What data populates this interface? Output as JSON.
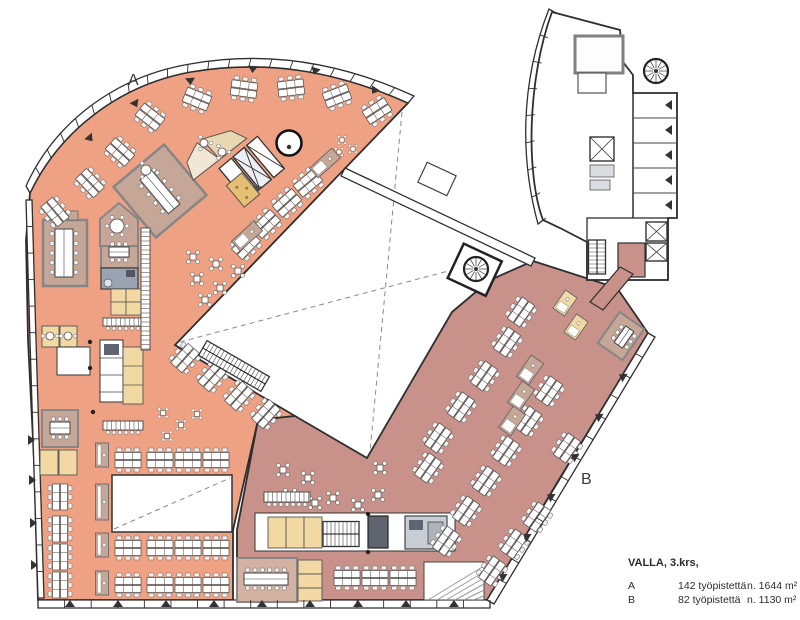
{
  "zone_labels": {
    "a": "A",
    "b": "B"
  },
  "legend": {
    "title": "VALLA, 3.krs,",
    "rows": [
      {
        "zone": "A",
        "workstations": "142 työpistettä",
        "area": "n. 1644 m²"
      },
      {
        "zone": "B",
        "workstations": "82 työpistettä",
        "area": "n. 1130 m²"
      }
    ]
  },
  "colors": {
    "zone_a": "#efa183",
    "zone_b": "#c8928a",
    "room_tan": "#c6a697",
    "room_tan_light": "#d3b2a2",
    "wedge_light": "#f0e8d4",
    "wedge_dark": "#e7d7b2",
    "yellow": "#f2d8a2",
    "gray_blue": "#9aa3b2",
    "gray_dark": "#5f6570",
    "gray_light": "#c9cdd4",
    "gold": "#e4bf74",
    "wall": "#2e2e2e",
    "room_border": "#868686",
    "white": "#ffffff"
  },
  "plan": {
    "desk_clusters": [
      [
        150,
        117,
        38
      ],
      [
        197,
        99,
        22
      ],
      [
        244,
        89,
        8
      ],
      [
        291,
        88,
        -7
      ],
      [
        337,
        96,
        -21
      ],
      [
        377,
        111,
        -33
      ],
      [
        120,
        152,
        42
      ],
      [
        90,
        183,
        46
      ],
      [
        55,
        212,
        50
      ],
      [
        308,
        183,
        -40
      ],
      [
        287,
        203,
        -42
      ],
      [
        266,
        224,
        -44
      ],
      [
        246,
        245,
        -46
      ],
      [
        185,
        358,
        -48
      ],
      [
        212,
        377,
        -48
      ],
      [
        239,
        396,
        -48
      ],
      [
        266,
        414,
        -48
      ],
      [
        128,
        460,
        0
      ],
      [
        160,
        460,
        0
      ],
      [
        188,
        460,
        0
      ],
      [
        216,
        460,
        0
      ],
      [
        128,
        548,
        0
      ],
      [
        160,
        548,
        0
      ],
      [
        188,
        548,
        0
      ],
      [
        216,
        548,
        0
      ],
      [
        128,
        585,
        0
      ],
      [
        160,
        585,
        0
      ],
      [
        188,
        585,
        0
      ],
      [
        216,
        585,
        0
      ],
      [
        60,
        497,
        90
      ],
      [
        60,
        529,
        90
      ],
      [
        60,
        557,
        90
      ],
      [
        60,
        585,
        90
      ],
      [
        347,
        578,
        0
      ],
      [
        375,
        578,
        0
      ],
      [
        403,
        578,
        0
      ],
      [
        521,
        312,
        -55
      ],
      [
        507,
        342,
        -55
      ],
      [
        484,
        376,
        -55
      ],
      [
        461,
        407,
        -55
      ],
      [
        438,
        438,
        -55
      ],
      [
        549,
        391,
        -55
      ],
      [
        528,
        421,
        -55
      ],
      [
        506,
        451,
        -55
      ],
      [
        486,
        481,
        -55
      ],
      [
        466,
        511,
        -55
      ],
      [
        446,
        541,
        -55
      ],
      [
        537,
        517,
        -55
      ],
      [
        514,
        544,
        -55
      ],
      [
        492,
        571,
        -55
      ],
      [
        567,
        448,
        -55
      ],
      [
        428,
        468,
        -55
      ]
    ],
    "x_tables": [
      [
        193,
        257,
        1
      ],
      [
        216,
        264,
        1
      ],
      [
        197,
        279,
        1
      ],
      [
        220,
        288,
        1
      ],
      [
        238,
        271,
        1
      ],
      [
        205,
        300,
        1
      ],
      [
        283,
        470,
        1
      ],
      [
        308,
        478,
        1
      ],
      [
        290,
        495,
        1
      ],
      [
        315,
        503,
        1
      ],
      [
        333,
        498,
        1
      ],
      [
        358,
        505,
        1
      ],
      [
        378,
        495,
        1
      ],
      [
        380,
        468,
        1
      ],
      [
        342,
        140,
        0.7
      ],
      [
        353,
        149,
        0.7
      ],
      [
        339,
        152,
        0.7
      ],
      [
        163,
        413,
        0.8
      ],
      [
        181,
        425,
        0.8
      ],
      [
        167,
        436,
        0.8
      ],
      [
        197,
        414,
        0.8
      ]
    ],
    "pods": [
      [
        325,
        163,
        -42,
        30,
        13,
        "t"
      ],
      [
        247,
        236,
        -42,
        30,
        13,
        "t"
      ],
      [
        102,
        455,
        0,
        13,
        24,
        "t"
      ],
      [
        102,
        545,
        0,
        13,
        24,
        "t"
      ],
      [
        102,
        583,
        0,
        13,
        24,
        "t"
      ],
      [
        102,
        502,
        0,
        13,
        36,
        "t"
      ],
      [
        530,
        370,
        -55,
        26,
        15,
        "t"
      ],
      [
        521,
        396,
        -55,
        26,
        15,
        "t"
      ],
      [
        512,
        421,
        -55,
        26,
        15,
        "t"
      ],
      [
        565,
        303,
        -55,
        22,
        14,
        "y"
      ],
      [
        576,
        327,
        -55,
        22,
        14,
        "y"
      ]
    ],
    "striped_bands": [
      [
        103,
        318,
        38,
        8
      ],
      [
        103,
        421,
        40,
        9
      ],
      [
        141,
        228,
        9,
        122
      ],
      [
        264,
        492,
        46,
        10
      ]
    ],
    "long_tables": [
      [
        64,
        253,
        18,
        48,
        0,
        5
      ],
      [
        160,
        192,
        15,
        44,
        -40,
        4
      ],
      [
        119,
        252,
        20,
        10,
        0,
        3
      ],
      [
        60,
        428,
        20,
        12,
        0,
        3
      ],
      [
        266,
        579,
        44,
        12,
        0,
        6
      ],
      [
        624,
        337,
        20,
        10,
        -55,
        3
      ]
    ],
    "round_tables": [
      [
        117,
        226,
        7,
        6
      ],
      [
        146,
        170,
        5,
        3
      ],
      [
        204,
        143,
        4,
        3
      ],
      [
        222,
        152,
        4,
        3
      ],
      [
        50,
        336,
        4,
        2
      ],
      [
        68,
        336,
        4,
        2
      ]
    ],
    "spirals": [
      [
        476,
        269,
        12
      ],
      [
        656,
        71,
        12
      ]
    ],
    "stairs": [
      [
        234,
        366,
        72,
        17,
        30
      ],
      [
        341,
        534,
        36,
        25,
        0
      ],
      [
        597,
        257,
        17,
        34,
        0
      ]
    ],
    "elevator_boxes": [
      [
        590,
        137,
        24,
        24
      ],
      [
        646,
        222,
        21,
        19
      ],
      [
        646,
        243,
        21,
        18
      ]
    ],
    "dots": [
      [
        90,
        342
      ],
      [
        90,
        368
      ],
      [
        93,
        412
      ],
      [
        368,
        514
      ],
      [
        368,
        552
      ]
    ],
    "facade_triangles": [
      [
        70,
        607,
        0
      ],
      [
        118,
        607,
        0
      ],
      [
        166,
        607,
        0
      ],
      [
        214,
        607,
        0
      ],
      [
        262,
        607,
        0
      ],
      [
        310,
        607,
        0
      ],
      [
        358,
        607,
        0
      ],
      [
        406,
        607,
        0
      ],
      [
        454,
        607,
        0
      ],
      [
        28,
        440,
        90
      ],
      [
        29,
        480,
        90
      ],
      [
        30,
        523,
        90
      ],
      [
        31,
        565,
        90
      ],
      [
        625,
        378,
        -59
      ],
      [
        601,
        418,
        -59
      ],
      [
        577,
        458,
        -59
      ],
      [
        553,
        498,
        -59
      ],
      [
        529,
        538,
        -59
      ],
      [
        505,
        578,
        -59
      ],
      [
        672,
        105,
        -90
      ],
      [
        672,
        130,
        -90
      ],
      [
        672,
        155,
        -90
      ],
      [
        672,
        180,
        -90
      ],
      [
        672,
        205,
        -90
      ],
      [
        88,
        136,
        139
      ],
      [
        134,
        101,
        153
      ],
      [
        190,
        78,
        175
      ],
      [
        253,
        66,
        185
      ],
      [
        316,
        68,
        197
      ],
      [
        376,
        88,
        213
      ]
    ],
    "facade_ticks": [
      [
        "arcOut",
        "arcIn",
        21
      ],
      [
        "lfOut",
        "lfIn",
        15
      ],
      [
        "btOut",
        "btIn",
        17
      ],
      [
        "bfOut",
        "bfIn",
        13
      ],
      [
        "twOut",
        "twIn",
        8
      ]
    ]
  }
}
